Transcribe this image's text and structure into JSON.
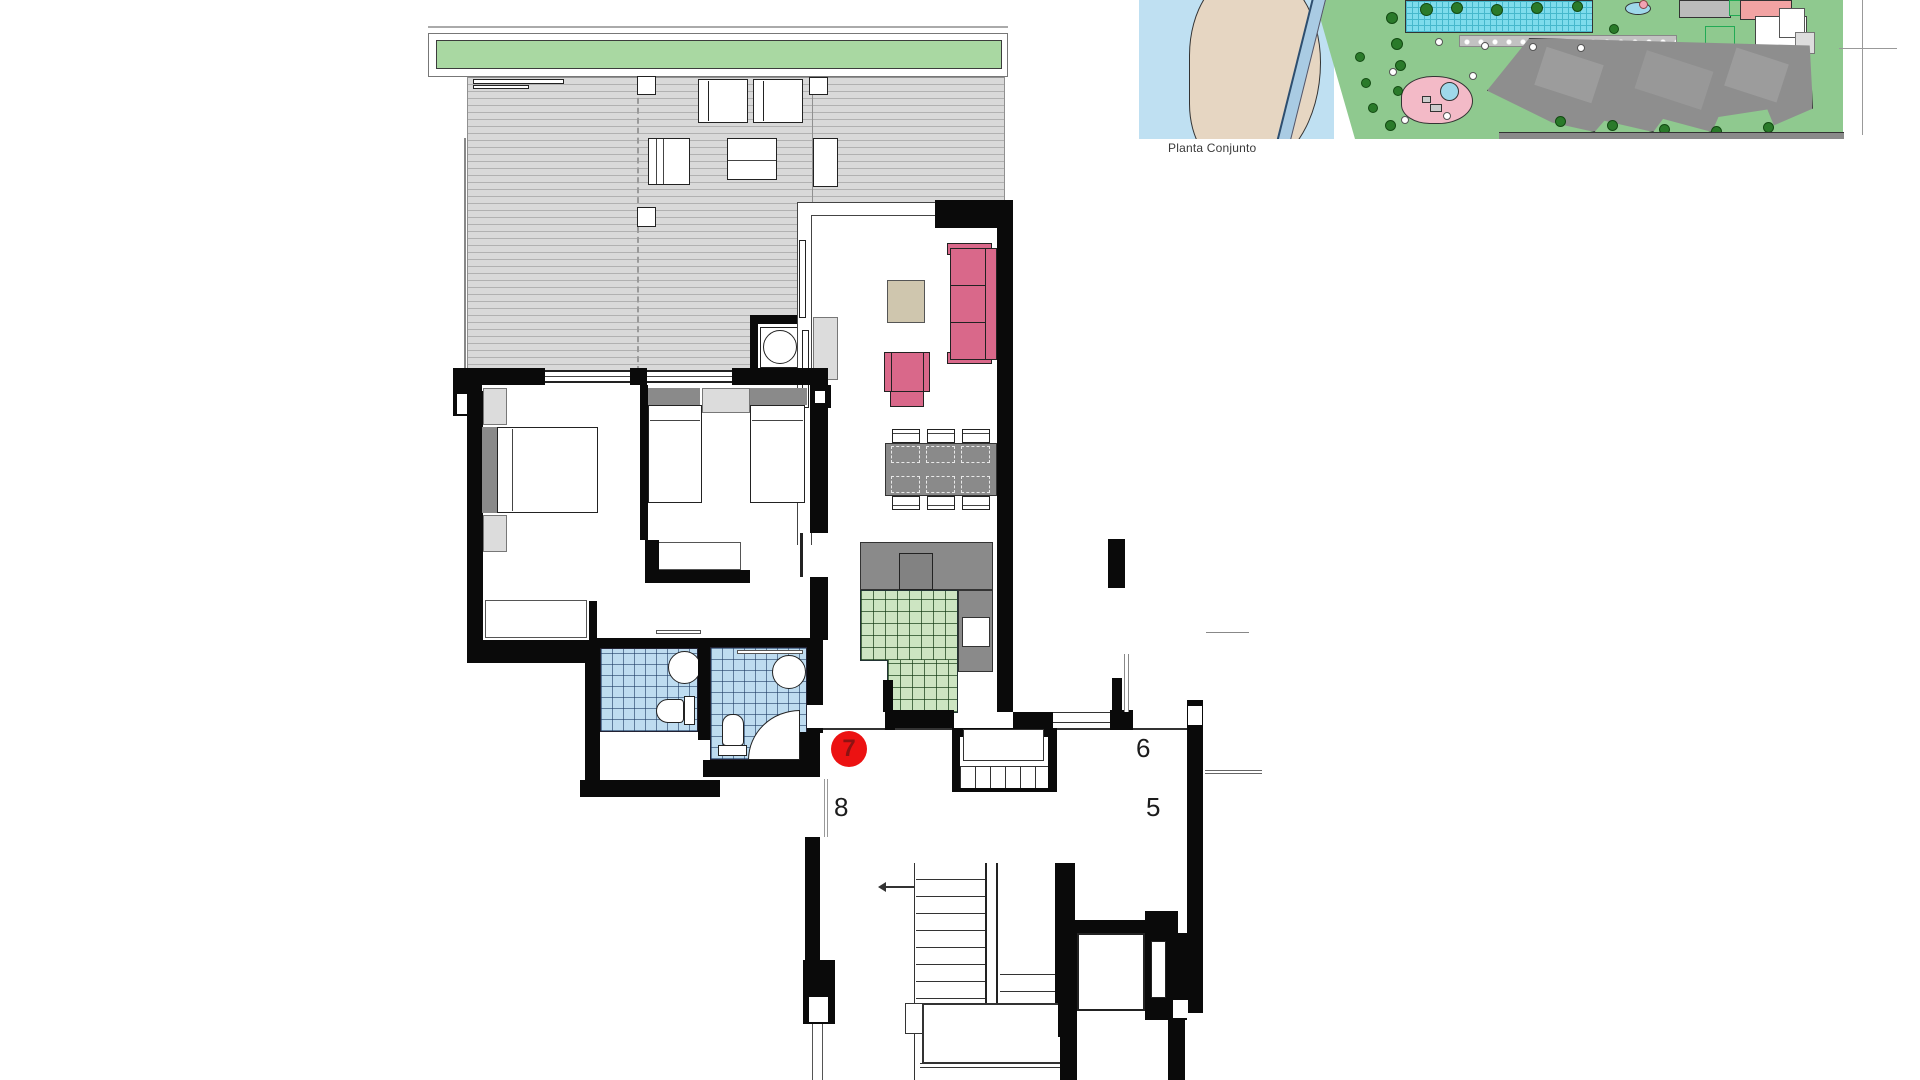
{
  "site_plan": {
    "caption": "Planta Conjunto"
  },
  "units": {
    "current_marker": {
      "number": "7"
    },
    "neighbors": [
      {
        "number": "8"
      },
      {
        "number": "6"
      },
      {
        "number": "5"
      }
    ]
  },
  "palette": {
    "marker_red": "#ec1212",
    "planter_green": "#a9d8a2",
    "kitchen_tile_green": "#cde5c2",
    "bath_tile_blue": "#bedcf0",
    "sofa_pink": "#d9688a",
    "water_blue": "#bfe0f2",
    "lawn_green": "#8fc98f",
    "pool_cyan": "#7edcec",
    "roof_gray": "#8e8e8e"
  }
}
